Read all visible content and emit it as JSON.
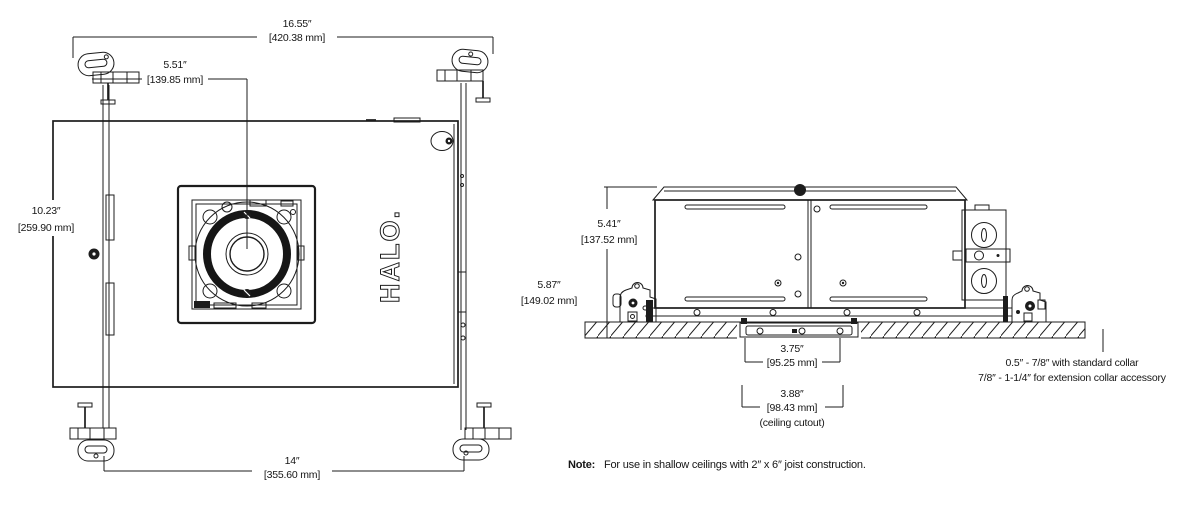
{
  "brand": {
    "logo": "HALO."
  },
  "plan_view": {
    "overall_width": {
      "in": "16.55″",
      "mm": "[420.38 mm]"
    },
    "aperture_center": {
      "in": "5.51″",
      "mm": "[139.85 mm]"
    },
    "housing_depth": {
      "in": "10.23″",
      "mm": "[259.90 mm]"
    },
    "bar_length": {
      "in": "14″",
      "mm": "[355.60 mm]"
    }
  },
  "side_view": {
    "housing_height": {
      "in": "5.41″",
      "mm": "[137.52 mm]"
    },
    "overall_height": {
      "in": "5.87″",
      "mm": "[149.02 mm]"
    },
    "collar_width": {
      "in": "3.75″",
      "mm": "[95.25 mm]"
    },
    "ceiling_cutout": {
      "in": "3.88″",
      "mm": "[98.43 mm]",
      "caption": "(ceiling cutout)"
    },
    "collar_range": {
      "line1": "0.5″ - 7/8″ with standard collar",
      "line2": "7/8″ - 1-1/4″ for extension collar accessory"
    }
  },
  "footnote": {
    "label": "Note:",
    "text": "For use in shallow ceilings with 2″ x 6″ joist construction."
  }
}
